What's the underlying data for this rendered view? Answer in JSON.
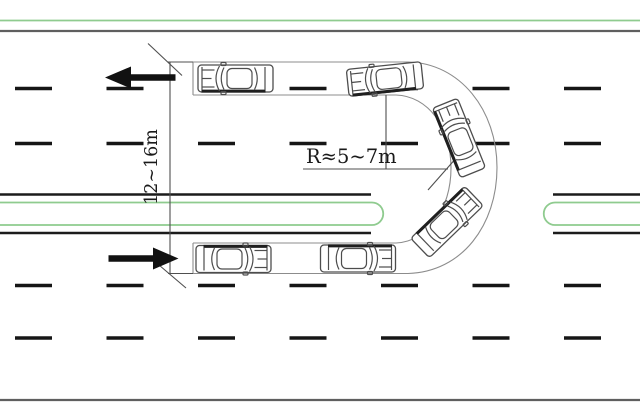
{
  "diagram": {
    "type": "road-u-turn-schematic",
    "annotations": {
      "turning_zone_width": "12~16m",
      "turning_radius": "R≈5~7m"
    },
    "traffic": {
      "top_road_direction": "left",
      "bottom_road_direction": "right"
    },
    "icons": {
      "top_arrow": "arrow-left-icon",
      "bottom_arrow": "arrow-right-icon"
    }
  },
  "colors": {
    "median_green": "#8fcb8f",
    "road_edge": "#5f5f5f",
    "median_black": "#1c1c1c",
    "lane_dash": "#161616",
    "path_outline": "#8c8c8c",
    "dim_line": "#4f4f4f",
    "arrow": "#111111",
    "car_outline": "#4d4d4d"
  },
  "road": {
    "dash_rows": [
      88.5,
      143.5,
      285.5,
      338
    ],
    "dash_xs": [
      15,
      106.5,
      198,
      289.5,
      381,
      472.5,
      564
    ],
    "dash_len": 37
  },
  "cars": [
    {
      "x": 235.5,
      "y": 78.5,
      "angle": 0
    },
    {
      "x": 385,
      "y": 79,
      "angle": -6
    },
    {
      "x": 459,
      "y": 138,
      "angle": 68
    },
    {
      "x": 447,
      "y": 222,
      "angle": 136
    },
    {
      "x": 358,
      "y": 258.5,
      "angle": 180
    },
    {
      "x": 233.5,
      "y": 259,
      "angle": 180
    }
  ]
}
